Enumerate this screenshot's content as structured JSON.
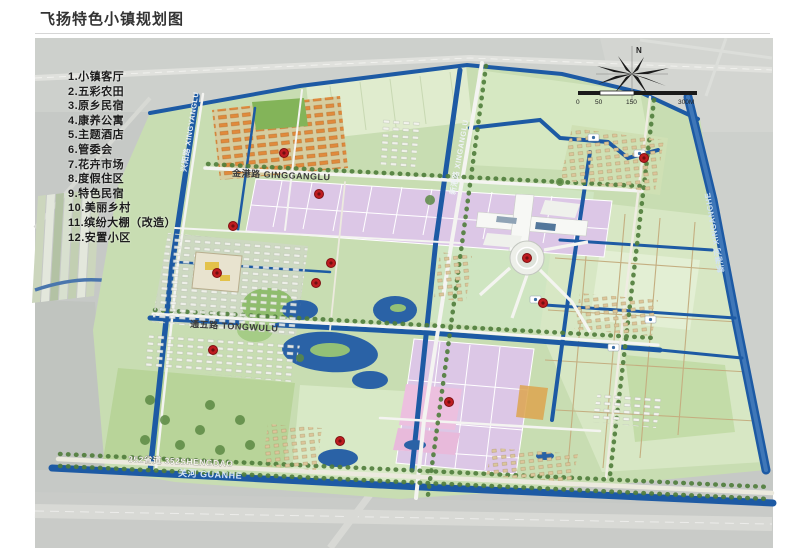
{
  "page": {
    "title": "飞扬特色小镇规划图"
  },
  "legend": {
    "items": [
      "1.小镇客厅",
      "2.五彩农田",
      "3.原乡民宿",
      "4.康养公寓",
      "5.主题酒店",
      "6.管委会",
      "7.花卉市场",
      "8.度假住区",
      "9.特色民宿",
      "10.美丽乡村",
      "11.缤纷大棚（改造）",
      "12.安置小区"
    ]
  },
  "map": {
    "roads": {
      "jingang": "金港路 GINGGANGLU",
      "tongwu": "通五路 TONGWULU",
      "shengdao": "352省道 352SHENGDAO",
      "guanhe": "关河 GUANHE",
      "xingyang": "兴阳路 XINGYANGLU",
      "xingang": "新港路 XINGANGLU",
      "xinganghe": "新港河 XINGANGHE"
    },
    "compass": {
      "north": "N"
    },
    "scale": {
      "ticks": [
        "0",
        "50",
        "150",
        "300M"
      ]
    },
    "markers": [
      {
        "x": 284,
        "y": 153
      },
      {
        "x": 319,
        "y": 194
      },
      {
        "x": 233,
        "y": 226
      },
      {
        "x": 217,
        "y": 273
      },
      {
        "x": 331,
        "y": 263
      },
      {
        "x": 316,
        "y": 283
      },
      {
        "x": 213,
        "y": 350
      },
      {
        "x": 527,
        "y": 258
      },
      {
        "x": 543,
        "y": 303
      },
      {
        "x": 449,
        "y": 402
      },
      {
        "x": 644,
        "y": 158
      },
      {
        "x": 340,
        "y": 441
      }
    ],
    "colors": {
      "water": "#1d5aa4",
      "marker": "#bf1c20",
      "marker_edge": "#7e1012",
      "purple": "#dcc7e6",
      "plan_green": "#c8ddb2"
    }
  }
}
